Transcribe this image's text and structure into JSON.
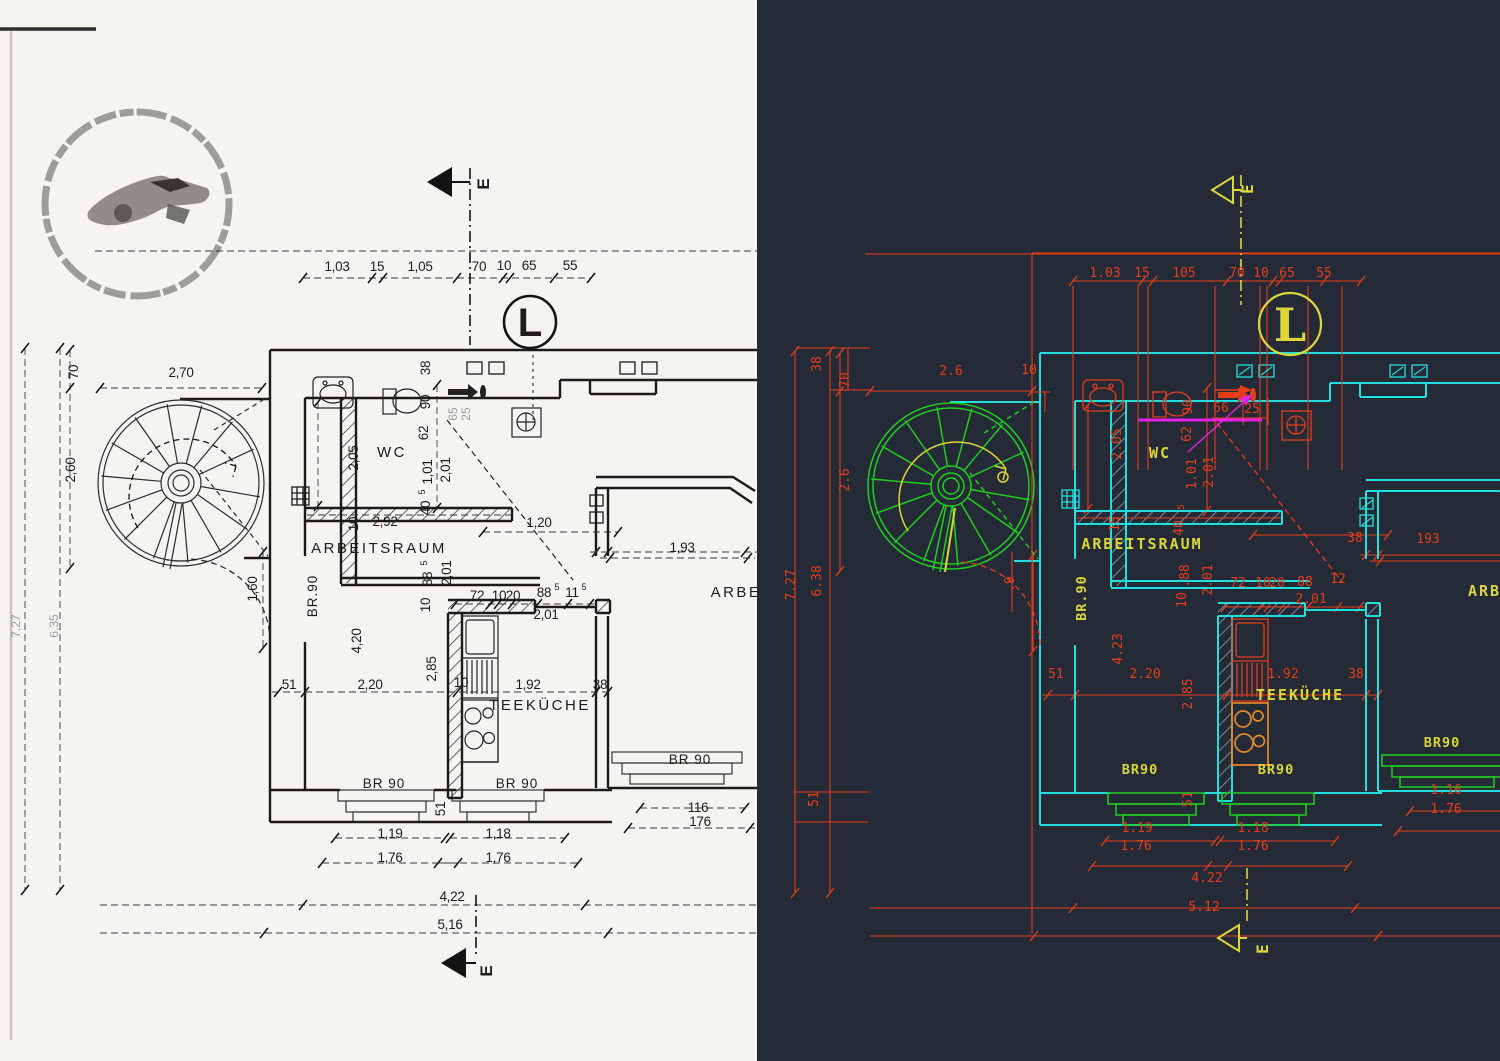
{
  "colors": {
    "cad_background": "#242b37",
    "cad_dimension_red": "#e33d1a",
    "cad_wall_cyan": "#24dede",
    "cad_stair_green": "#22cc22",
    "cad_text_yellow": "#ddd63a",
    "cad_stove_orange": "#e2882c",
    "cad_magenta": "#e322e3",
    "scan_ink": "#1d1d1d",
    "scan_paper": "#f5f4f1"
  },
  "left": {
    "name": "scanned-floor-plan",
    "labels": [
      {
        "t": "1,03",
        "x": 337,
        "y": 271
      },
      {
        "t": "15",
        "x": 377,
        "y": 271
      },
      {
        "t": "1,05",
        "x": 420,
        "y": 271
      },
      {
        "t": "70",
        "x": 479,
        "y": 271
      },
      {
        "t": "10",
        "x": 504,
        "y": 270
      },
      {
        "t": "65",
        "x": 529,
        "y": 270
      },
      {
        "t": "55",
        "x": 570,
        "y": 270
      },
      {
        "t": "2,70",
        "x": 181,
        "y": 377
      },
      {
        "t": "38",
        "x": 430,
        "y": 368,
        "r": 1
      },
      {
        "t": "70",
        "x": 78,
        "y": 372,
        "r": 1
      },
      {
        "t": "2,60",
        "x": 75,
        "y": 470,
        "r": 1
      },
      {
        "t": "2,05",
        "x": 358,
        "y": 458,
        "r": 1
      },
      {
        "t": "90",
        "x": 430,
        "y": 402,
        "r": 1
      },
      {
        "t": "62",
        "x": 428,
        "y": 433,
        "r": 1
      },
      {
        "t": "65",
        "x": 457,
        "y": 414,
        "r": 1,
        "k": "faint"
      },
      {
        "t": "25",
        "x": 470,
        "y": 414,
        "r": 1,
        "k": "faint"
      },
      {
        "t": "WC",
        "x": 392,
        "y": 457,
        "k": "room"
      },
      {
        "t": "1,01",
        "x": 432,
        "y": 472,
        "r": 1
      },
      {
        "t": "2,01",
        "x": 450,
        "y": 470,
        "r": 1
      },
      {
        "t": "5",
        "x": 425,
        "y": 492,
        "r": 1,
        "k": "sup"
      },
      {
        "t": "40",
        "x": 430,
        "y": 508,
        "r": 1
      },
      {
        "t": "10",
        "x": 358,
        "y": 524,
        "r": 1
      },
      {
        "t": "2,92",
        "x": 385,
        "y": 526
      },
      {
        "t": "1,20",
        "x": 539,
        "y": 527
      },
      {
        "t": "ARBEITSRAUM",
        "x": 379,
        "y": 553,
        "k": "room"
      },
      {
        "t": "1,93",
        "x": 682,
        "y": 552
      },
      {
        "t": "ARBE",
        "x": 736,
        "y": 597,
        "k": "room"
      },
      {
        "t": "BR.90",
        "x": 317,
        "y": 596,
        "r": 1,
        "k": "br"
      },
      {
        "t": "1,60",
        "x": 257,
        "y": 589,
        "r": 1
      },
      {
        "t": "5",
        "x": 427,
        "y": 563,
        "r": 1,
        "k": "sup"
      },
      {
        "t": "88",
        "x": 432,
        "y": 579,
        "r": 1
      },
      {
        "t": "10",
        "x": 430,
        "y": 605,
        "r": 1
      },
      {
        "t": "2,01",
        "x": 451,
        "y": 573,
        "r": 1
      },
      {
        "t": "72",
        "x": 477,
        "y": 600
      },
      {
        "t": "10",
        "x": 499,
        "y": 600
      },
      {
        "t": "20",
        "x": 513,
        "y": 600
      },
      {
        "t": "88",
        "x": 544,
        "y": 597
      },
      {
        "t": "5",
        "x": 557,
        "y": 590,
        "k": "sup"
      },
      {
        "t": "11",
        "x": 572,
        "y": 597
      },
      {
        "t": "5",
        "x": 584,
        "y": 590,
        "k": "sup"
      },
      {
        "t": "2,01",
        "x": 546,
        "y": 619
      },
      {
        "t": "4,20",
        "x": 361,
        "y": 641,
        "r": 1
      },
      {
        "t": "2,85",
        "x": 436,
        "y": 669,
        "r": 1
      },
      {
        "t": "51",
        "x": 289,
        "y": 689
      },
      {
        "t": "2,20",
        "x": 370,
        "y": 689
      },
      {
        "t": "10",
        "x": 461,
        "y": 687
      },
      {
        "t": "1,92",
        "x": 528,
        "y": 689
      },
      {
        "t": "38",
        "x": 600,
        "y": 689
      },
      {
        "t": "TEEKÜCHE",
        "x": 540,
        "y": 710,
        "k": "room"
      },
      {
        "t": "BR 90",
        "x": 384,
        "y": 788,
        "k": "br"
      },
      {
        "t": "BR 90",
        "x": 517,
        "y": 788,
        "k": "br"
      },
      {
        "t": "BR 90",
        "x": 690,
        "y": 764,
        "k": "br"
      },
      {
        "t": "51",
        "x": 445,
        "y": 809,
        "r": 1
      },
      {
        "t": "116",
        "x": 698,
        "y": 812
      },
      {
        "t": "176",
        "x": 700,
        "y": 826
      },
      {
        "t": "1,19",
        "x": 390,
        "y": 838
      },
      {
        "t": "1,76",
        "x": 390,
        "y": 862
      },
      {
        "t": "1,18",
        "x": 498,
        "y": 838
      },
      {
        "t": "1,76",
        "x": 498,
        "y": 862
      },
      {
        "t": "4,22",
        "x": 452,
        "y": 901
      },
      {
        "t": "5,16",
        "x": 450,
        "y": 929
      },
      {
        "t": "7,27",
        "x": 20,
        "y": 626,
        "r": 1,
        "k": "faint"
      },
      {
        "t": "6,35",
        "x": 58,
        "y": 626,
        "r": 1,
        "k": "faint"
      },
      {
        "t": "L",
        "x": 530,
        "y": 336,
        "k": "lmark"
      },
      {
        "t": "E",
        "x": 489,
        "y": 184,
        "r": 1,
        "k": "emark"
      },
      {
        "t": "E",
        "x": 492,
        "y": 971,
        "r": 1,
        "k": "emark"
      }
    ]
  },
  "right": {
    "name": "cad-vector-floor-plan",
    "labels": [
      {
        "t": "1.03",
        "x": 1105,
        "y": 277
      },
      {
        "t": "15",
        "x": 1142,
        "y": 277
      },
      {
        "t": "105",
        "x": 1184,
        "y": 277
      },
      {
        "t": "70",
        "x": 1237,
        "y": 277
      },
      {
        "t": "10",
        "x": 1261,
        "y": 277
      },
      {
        "t": "65",
        "x": 1287,
        "y": 277
      },
      {
        "t": "55",
        "x": 1324,
        "y": 277
      },
      {
        "t": "2.6",
        "x": 951,
        "y": 375
      },
      {
        "t": "10",
        "x": 1029,
        "y": 374
      },
      {
        "t": "38",
        "x": 821,
        "y": 364,
        "r": 1
      },
      {
        "t": "70",
        "x": 849,
        "y": 380,
        "r": 1
      },
      {
        "t": "2.6",
        "x": 849,
        "y": 480,
        "r": 1
      },
      {
        "t": "7.27",
        "x": 795,
        "y": 585,
        "r": 1
      },
      {
        "t": "6.38",
        "x": 821,
        "y": 581,
        "r": 1
      },
      {
        "t": "2.05",
        "x": 1121,
        "y": 444,
        "r": 1
      },
      {
        "t": "90",
        "x": 1192,
        "y": 407,
        "r": 1
      },
      {
        "t": "62",
        "x": 1191,
        "y": 434,
        "r": 1
      },
      {
        "t": "66",
        "x": 1221,
        "y": 412
      },
      {
        "t": "25",
        "x": 1252,
        "y": 413
      },
      {
        "t": "WC",
        "x": 1160,
        "y": 458,
        "k": "room"
      },
      {
        "t": "1.01",
        "x": 1196,
        "y": 474,
        "r": 1
      },
      {
        "t": "2.01",
        "x": 1213,
        "y": 472,
        "r": 1
      },
      {
        "t": "15",
        "x": 1119,
        "y": 524,
        "r": 1
      },
      {
        "t": "5",
        "x": 1184,
        "y": 507,
        "r": 1,
        "k": "sup"
      },
      {
        "t": "40",
        "x": 1183,
        "y": 528,
        "r": 1
      },
      {
        "t": "ARBEITSRAUM",
        "x": 1142,
        "y": 549,
        "k": "room"
      },
      {
        "t": "38",
        "x": 1355,
        "y": 542
      },
      {
        "t": "193",
        "x": 1428,
        "y": 543
      },
      {
        "t": "ARBE",
        "x": 1490,
        "y": 596,
        "k": "room"
      },
      {
        "t": "BR.90",
        "x": 1086,
        "y": 598,
        "r": 1,
        "k": "br"
      },
      {
        "t": ".88",
        "x": 1189,
        "y": 576,
        "r": 1
      },
      {
        "t": "10",
        "x": 1186,
        "y": 600,
        "r": 1
      },
      {
        "t": "2.01",
        "x": 1212,
        "y": 580,
        "r": 1
      },
      {
        "t": "72",
        "x": 1238,
        "y": 587
      },
      {
        "t": "10",
        "x": 1263,
        "y": 587
      },
      {
        "t": "20",
        "x": 1277,
        "y": 587
      },
      {
        "t": "88",
        "x": 1305,
        "y": 586
      },
      {
        "t": "12",
        "x": 1338,
        "y": 583
      },
      {
        "t": "2.01",
        "x": 1311,
        "y": 603
      },
      {
        "t": ".9",
        "x": 1014,
        "y": 584,
        "r": 1
      },
      {
        "t": "4.23",
        "x": 1122,
        "y": 649,
        "r": 1
      },
      {
        "t": "2.85",
        "x": 1192,
        "y": 694,
        "r": 1
      },
      {
        "t": "51",
        "x": 1056,
        "y": 678
      },
      {
        "t": "2.20",
        "x": 1145,
        "y": 678
      },
      {
        "t": "1.92",
        "x": 1283,
        "y": 678
      },
      {
        "t": "38",
        "x": 1356,
        "y": 678
      },
      {
        "t": "TEEKÜCHE",
        "x": 1300,
        "y": 700,
        "k": "room"
      },
      {
        "t": "BR90",
        "x": 1140,
        "y": 774,
        "k": "br"
      },
      {
        "t": "BR90",
        "x": 1276,
        "y": 774,
        "k": "br"
      },
      {
        "t": "BR90",
        "x": 1442,
        "y": 747,
        "k": "br"
      },
      {
        "t": "51",
        "x": 1192,
        "y": 799,
        "r": 1
      },
      {
        "t": "51",
        "x": 818,
        "y": 799,
        "r": 1
      },
      {
        "t": "1.16",
        "x": 1446,
        "y": 794
      },
      {
        "t": "1.76",
        "x": 1446,
        "y": 813
      },
      {
        "t": "1.19",
        "x": 1137,
        "y": 832
      },
      {
        "t": "1.76",
        "x": 1136,
        "y": 850
      },
      {
        "t": "1.18",
        "x": 1253,
        "y": 832
      },
      {
        "t": "1.76",
        "x": 1253,
        "y": 850
      },
      {
        "t": "4.22",
        "x": 1207,
        "y": 882
      },
      {
        "t": "5.12",
        "x": 1204,
        "y": 911
      },
      {
        "t": "L",
        "x": 1290,
        "y": 341,
        "k": "lmark"
      },
      {
        "t": "E",
        "x": 1253,
        "y": 189,
        "r": 1,
        "k": "emark"
      },
      {
        "t": "E",
        "x": 1268,
        "y": 949,
        "r": 1,
        "k": "emark"
      }
    ]
  }
}
